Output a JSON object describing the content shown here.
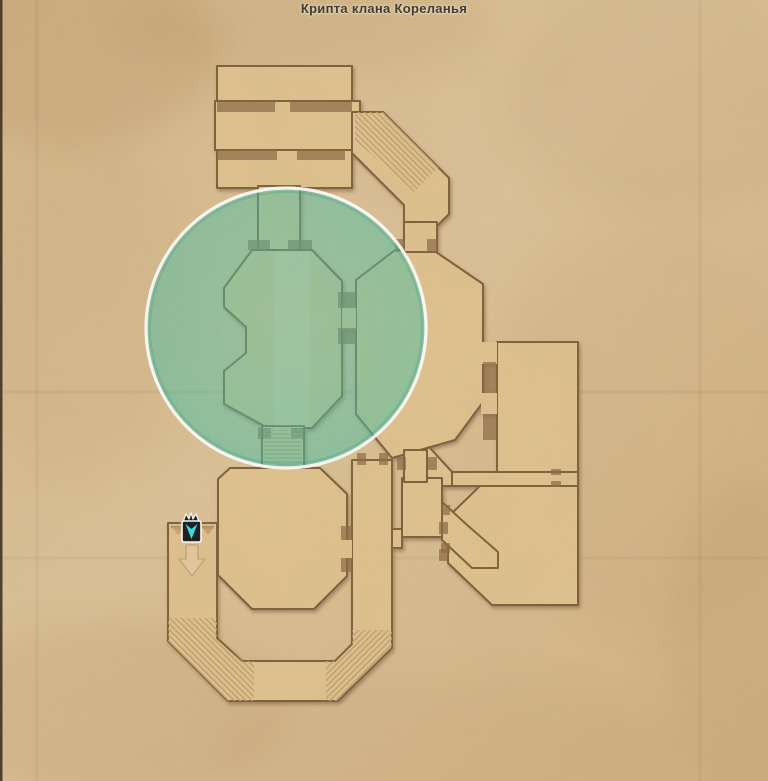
{
  "map": {
    "location_title": "Крипта клана Кореланья",
    "type": "dungeon-floor-map",
    "highlight": {
      "shape": "circle",
      "meaning": "current-area-highlight"
    },
    "player_marker": {
      "name": "player-position",
      "style": "cyan-chevron-banner"
    },
    "entrance_arrow": {
      "direction": "down"
    },
    "features": [
      "upper-halls",
      "upper-staircase",
      "north-entry-corridor",
      "central-chamber",
      "east-chamber",
      "northeast-room",
      "east-connecting-corridor",
      "southeast-room",
      "small-south-room",
      "lower-chamber",
      "u-shaped-south-corridor",
      "west-entrance-corridor"
    ]
  },
  "colors": {
    "parchment": "#d8bc91",
    "parchment_dark": "#c9a877",
    "room": "#dfc28f",
    "outline": "#7c5e3b",
    "slot": "#8a6a44",
    "shadow": "#6b4e2e",
    "hatch": "#bf9f70",
    "highlight": "#45c1a8",
    "highlight_rim": "#ffffff",
    "marker_body": "#14171b",
    "marker_accent": "#32e2e6",
    "title": "#3d3d35",
    "arrow_ghost": "#c9a878"
  }
}
